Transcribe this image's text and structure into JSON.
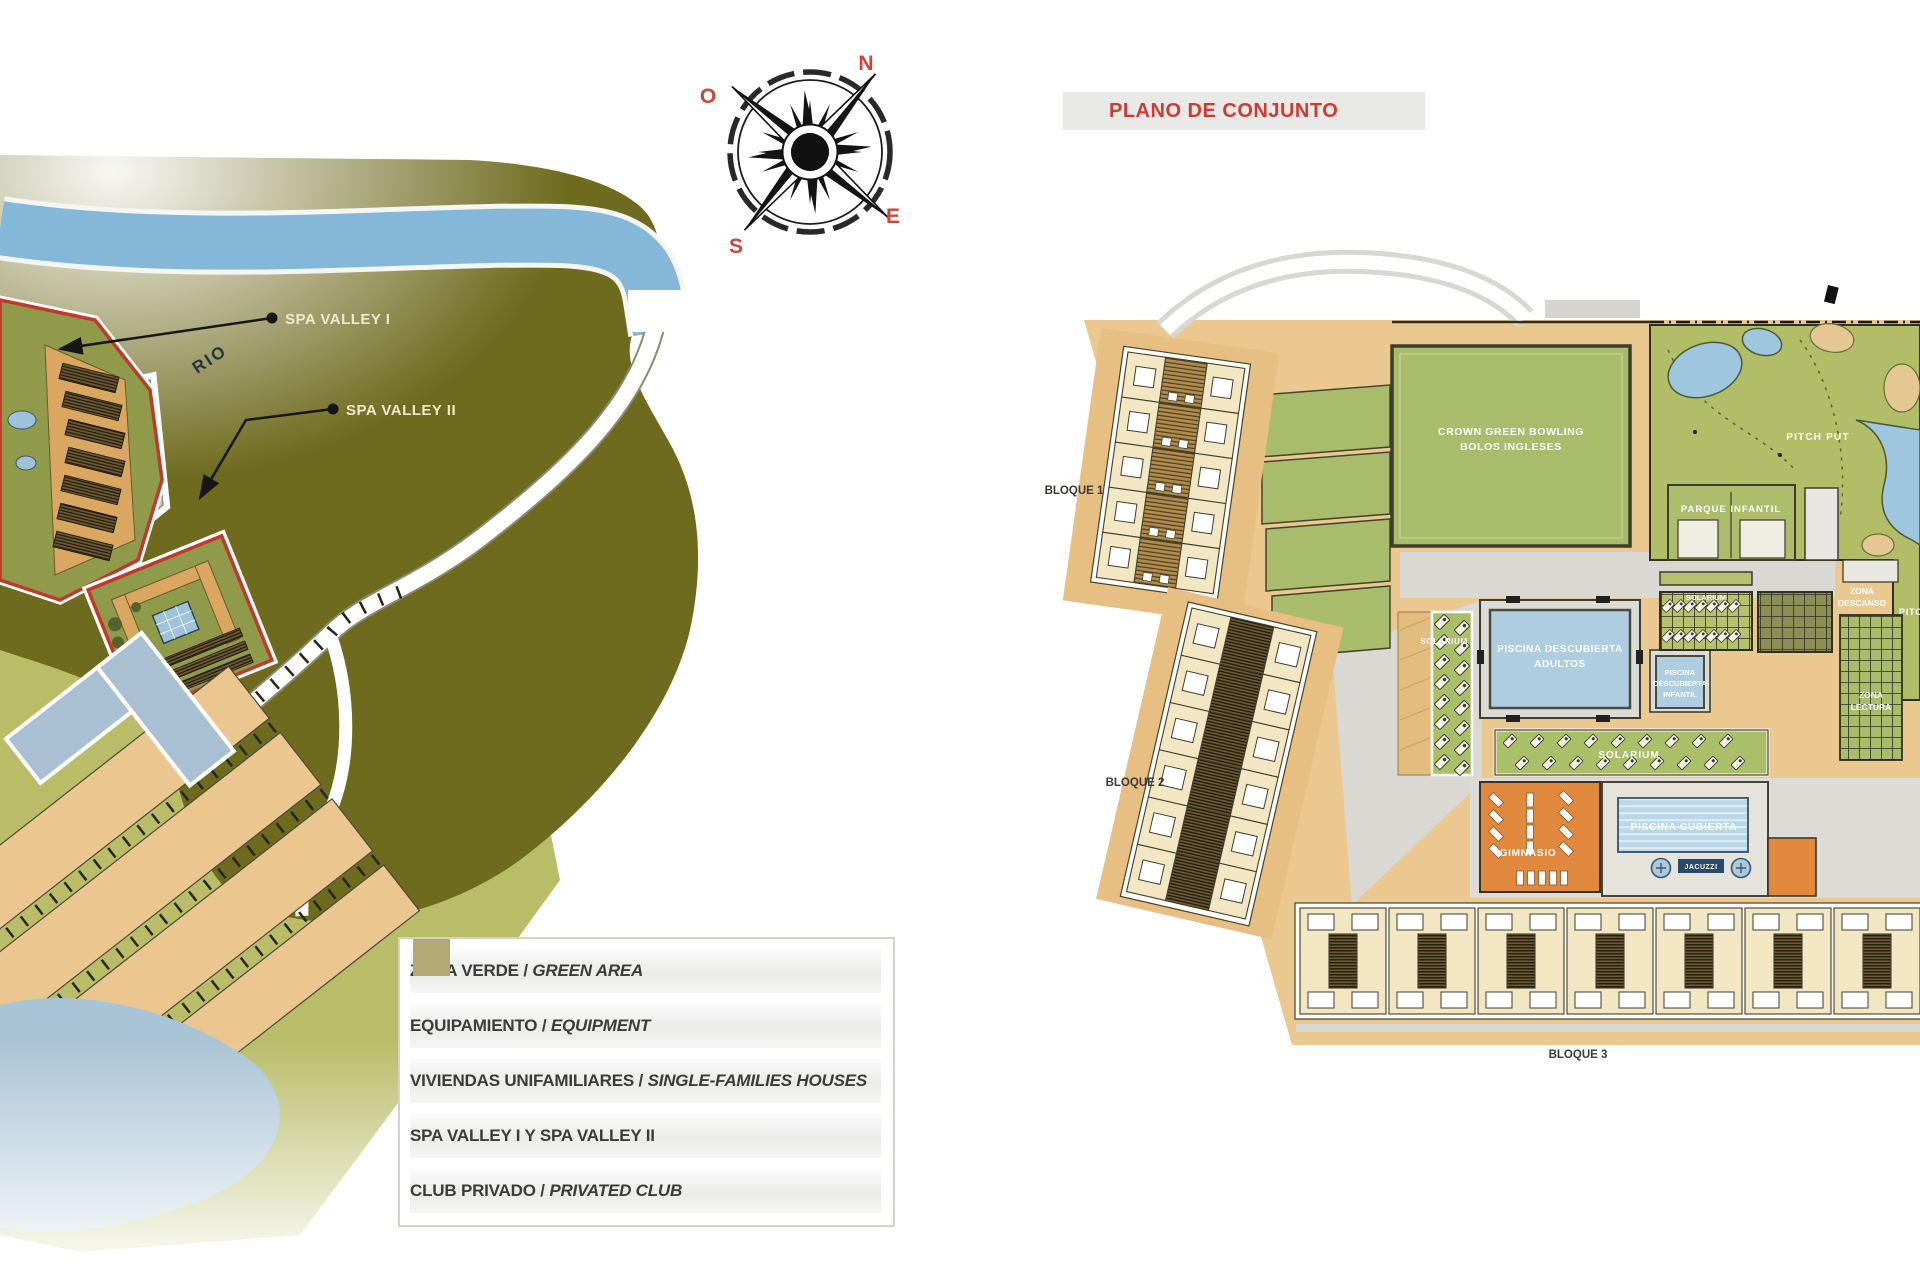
{
  "left_panel": {
    "river_label": "RIO",
    "compass": {
      "n": "N",
      "s": "S",
      "e": "E",
      "o": "O"
    },
    "callouts": [
      {
        "label": "SPA VALLEY I"
      },
      {
        "label": "SPA VALLEY II"
      }
    ],
    "legend": {
      "items": [
        {
          "main": "ZONA VERDE / ",
          "italic": "GREEN AREA",
          "color": "#8da254"
        },
        {
          "main": "EQUIPAMIENTO / ",
          "italic": "EQUIPMENT",
          "color": "#8cb0cc"
        },
        {
          "main": "VIVIENDAS UNIFAMILIARES / ",
          "italic": "SINGLE-FAMILIES HOUSES",
          "color": "#e9b777"
        },
        {
          "main": "SPA VALLEY I Y SPA VALLEY II",
          "italic": "",
          "color": "#e30d13"
        },
        {
          "main": "CLUB PRIVADO / ",
          "italic": "PRIVATED CLUB",
          "color": "#b3a974"
        }
      ]
    }
  },
  "right_panel": {
    "title": "PLANO DE CONJUNTO",
    "title_color": "#cf3b31",
    "blocks": {
      "b1": "BLOQUE 1",
      "b2": "BLOQUE 2",
      "b3": "BLOQUE 3"
    },
    "areas": {
      "bowling_line1": "CROWN GREEN BOWLING",
      "bowling_line2": "BOLOS INGLESES",
      "pitch_put": "PITCH PUT",
      "pitch_put_2": "PITCH PUT",
      "parque_infantil": "PARQUE  INFANTIL",
      "solarium_strip": "SOLARIUM",
      "solarium_pergola": "SOLARIUM",
      "solarium_main": "SOLARIUM",
      "adult_pool_line1": "PISCINA DESCUBIERTA",
      "adult_pool_line2": "ADULTOS",
      "infant_pool_line1": "PISCINA",
      "infant_pool_line2": "DESCUBIERTA",
      "infant_pool_line3": "INFANTIL",
      "zona_descanso_line1": "ZONA",
      "zona_descanso_line2": "DESCANSO",
      "zona_lectura_line1": "ZONA",
      "zona_lectura_line2": "LECTURA",
      "gimnasio": "GIMNASIO",
      "piscina_cubierta": "PISCINA CUBIERTA",
      "jacuzzi": "JACUZZI"
    }
  },
  "colors": {
    "accent_red": "#cf3b31",
    "terrain_dark": "#6e6a1e",
    "terrain_light": "#b9bd68",
    "river_blue": "#85b7d8",
    "plan_base_tan": "#eac88f",
    "plan_green": "#a9bc6b",
    "pool_blue": "#aecde0",
    "gym_orange": "#e0893e",
    "label_cream": "#efe8cf"
  }
}
